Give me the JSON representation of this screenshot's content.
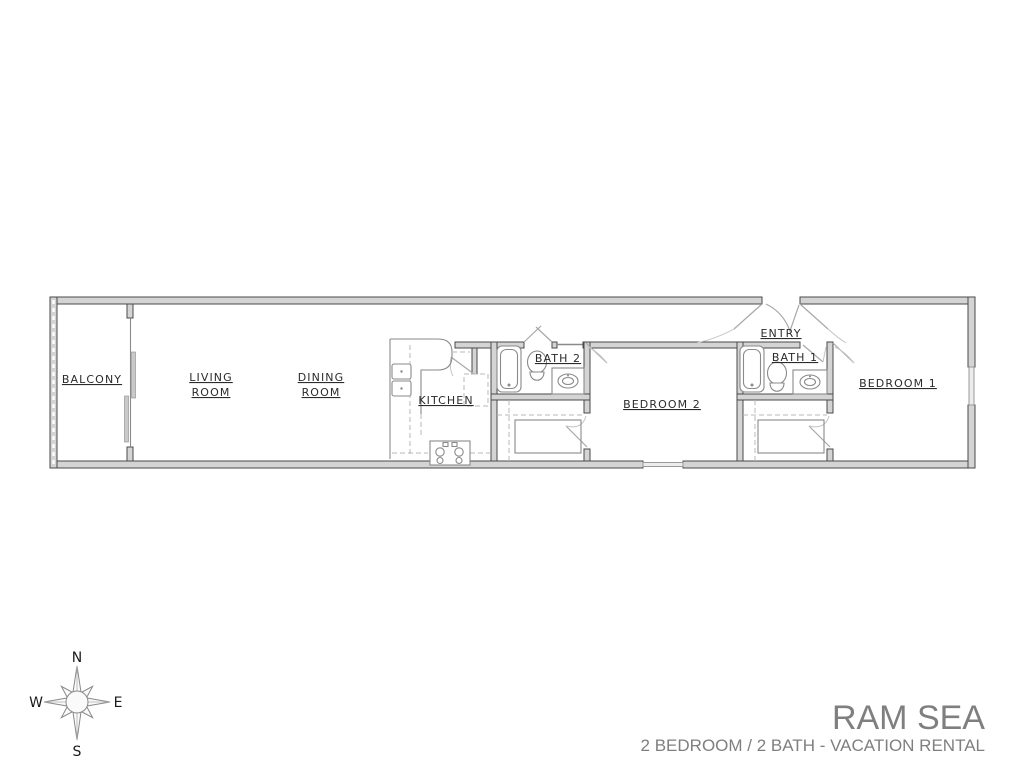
{
  "floor_plan": {
    "rooms": {
      "balcony": "BALCONY",
      "living_room": [
        "LIVING",
        "ROOM"
      ],
      "dining_room": [
        "DINING",
        "ROOM"
      ],
      "kitchen": "KITCHEN",
      "bath_2": "BATH 2",
      "bedroom_2": "BEDROOM 2",
      "entry": "ENTRY",
      "bath_1": "BATH 1",
      "bedroom_1": "BEDROOM 1"
    },
    "colors": {
      "wall_fill": "#d4d4d4",
      "wall_stroke": "#4a4a4a",
      "fixture_stroke": "#8a8a8a",
      "dashed_line": "#b8b8b8",
      "label_text": "#2b2b2b"
    }
  },
  "compass": {
    "north": "N",
    "south": "S",
    "east": "E",
    "west": "W"
  },
  "title_block": {
    "title": "RAM SEA",
    "subtitle": "2 BEDROOM / 2 BATH - VACATION RENTAL",
    "text_color": "#7f7f7f"
  }
}
